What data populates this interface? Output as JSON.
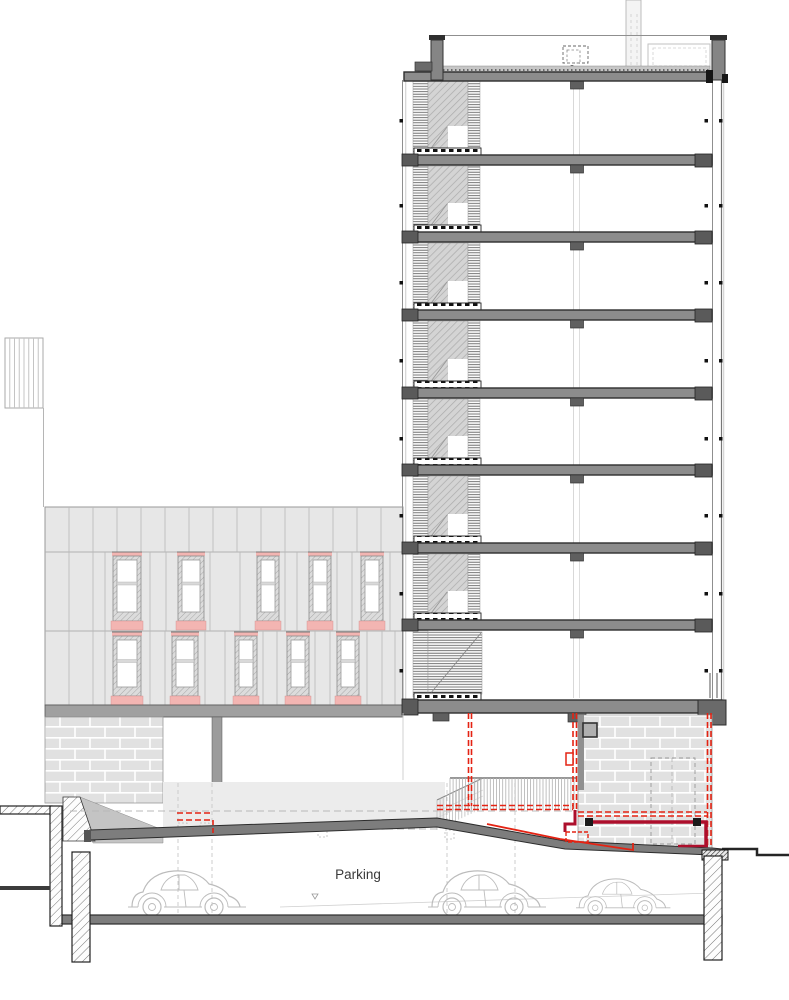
{
  "drawing": {
    "type": "architectural-building-section",
    "description": "Cross section through 8-storey tower with underground parking, adjacent 2-storey facade elevation, red highlighted duct/drainage route at ground floor"
  },
  "labels": {
    "parking": "Parking"
  },
  "colors": {
    "accent_red": "#e42313",
    "pipe_dark_red": "#ad0f2c",
    "window_pink": "#f3b5b2",
    "slab_gray": "#8c8c8c",
    "slab_edge": "#2e2e2e",
    "panel_gray": "#e7e7e7",
    "brick_gray": "#e1e1e1",
    "ramp_wall_gray": "#ececec",
    "text_gray": "#3a3a3a"
  },
  "tower": {
    "stories_above_ground": 8,
    "story_bands": [
      [
        80,
        155
      ],
      [
        165,
        232
      ],
      [
        242,
        310
      ],
      [
        320,
        388
      ],
      [
        398,
        465
      ],
      [
        475,
        543
      ],
      [
        553,
        620
      ],
      [
        630,
        698
      ]
    ],
    "slab_tops": [
      155,
      232,
      310,
      388,
      465,
      543,
      620
    ],
    "capital_ys": [
      81,
      165,
      242,
      320,
      398,
      475,
      553,
      630
    ],
    "paver_strip_ys": [
      148,
      225,
      303,
      381,
      458,
      536,
      613,
      693
    ],
    "story_mid_offset": 38
  },
  "left_building": {
    "top_joint_xs": [
      69,
      93,
      117,
      141,
      165,
      189,
      213,
      237,
      261,
      285,
      309,
      333,
      357,
      381
    ],
    "upper_joint_xs": [
      69,
      93,
      105,
      150,
      166,
      210,
      240,
      285,
      297,
      337,
      352,
      390
    ],
    "lower_joint_xs": [
      69,
      93,
      105,
      150,
      165,
      205,
      225,
      263,
      277,
      315,
      330,
      367,
      382,
      395
    ],
    "upper_windows": [
      {
        "x": 113,
        "w": 28
      },
      {
        "x": 178,
        "w": 26
      },
      {
        "x": 257,
        "w": 22
      },
      {
        "x": 309,
        "w": 22
      },
      {
        "x": 361,
        "w": 22
      }
    ],
    "lower_windows": [
      {
        "x": 113,
        "w": 28
      },
      {
        "x": 172,
        "w": 26
      },
      {
        "x": 235,
        "w": 22
      },
      {
        "x": 287,
        "w": 22
      },
      {
        "x": 337,
        "w": 22
      }
    ],
    "upper_row": {
      "win_y": 556,
      "win_h": 65,
      "head_y": 552,
      "sill_y": 621,
      "sill_h": 9
    },
    "lower_row": {
      "win_y": 636,
      "win_h": 60,
      "head_y": 632,
      "sill_y": 696,
      "sill_h": 9
    }
  },
  "neighbor_outline": {
    "stripe_count": 7
  },
  "parking": {
    "cars": [
      {
        "x": 128,
        "y": 866,
        "s": 1
      },
      {
        "x": 428,
        "y": 866,
        "s": 1
      },
      {
        "x": 576,
        "y": 875,
        "s": 0.8
      }
    ]
  },
  "red_system": {
    "dashed_vertical": [
      [
        468.5,
        713,
        806
      ],
      [
        471.5,
        713,
        806
      ],
      [
        573,
        713,
        810
      ],
      [
        576.5,
        713,
        810
      ],
      [
        707.5,
        713,
        845
      ],
      [
        711,
        713,
        845
      ]
    ],
    "dashed_horizontal": [
      [
        437,
        573,
        805.5
      ],
      [
        437,
        573,
        809.5
      ],
      [
        578,
        707,
        812
      ],
      [
        578,
        707,
        816
      ],
      [
        177,
        213,
        813
      ],
      [
        177,
        213,
        820
      ]
    ],
    "dashed_vertical_short": [
      [
        213,
        820,
        833
      ]
    ]
  },
  "guide_lines": {
    "gray_dashed_horizontal": [
      [
        70,
        707,
        811
      ],
      [
        177,
        437,
        829
      ]
    ],
    "gray_dashed_vertical_xs": [
      178,
      212,
      447,
      515
    ],
    "dashed_squares": [
      [
        178,
        823
      ],
      [
        200,
        823
      ],
      [
        318,
        828
      ],
      [
        445,
        830
      ]
    ]
  }
}
